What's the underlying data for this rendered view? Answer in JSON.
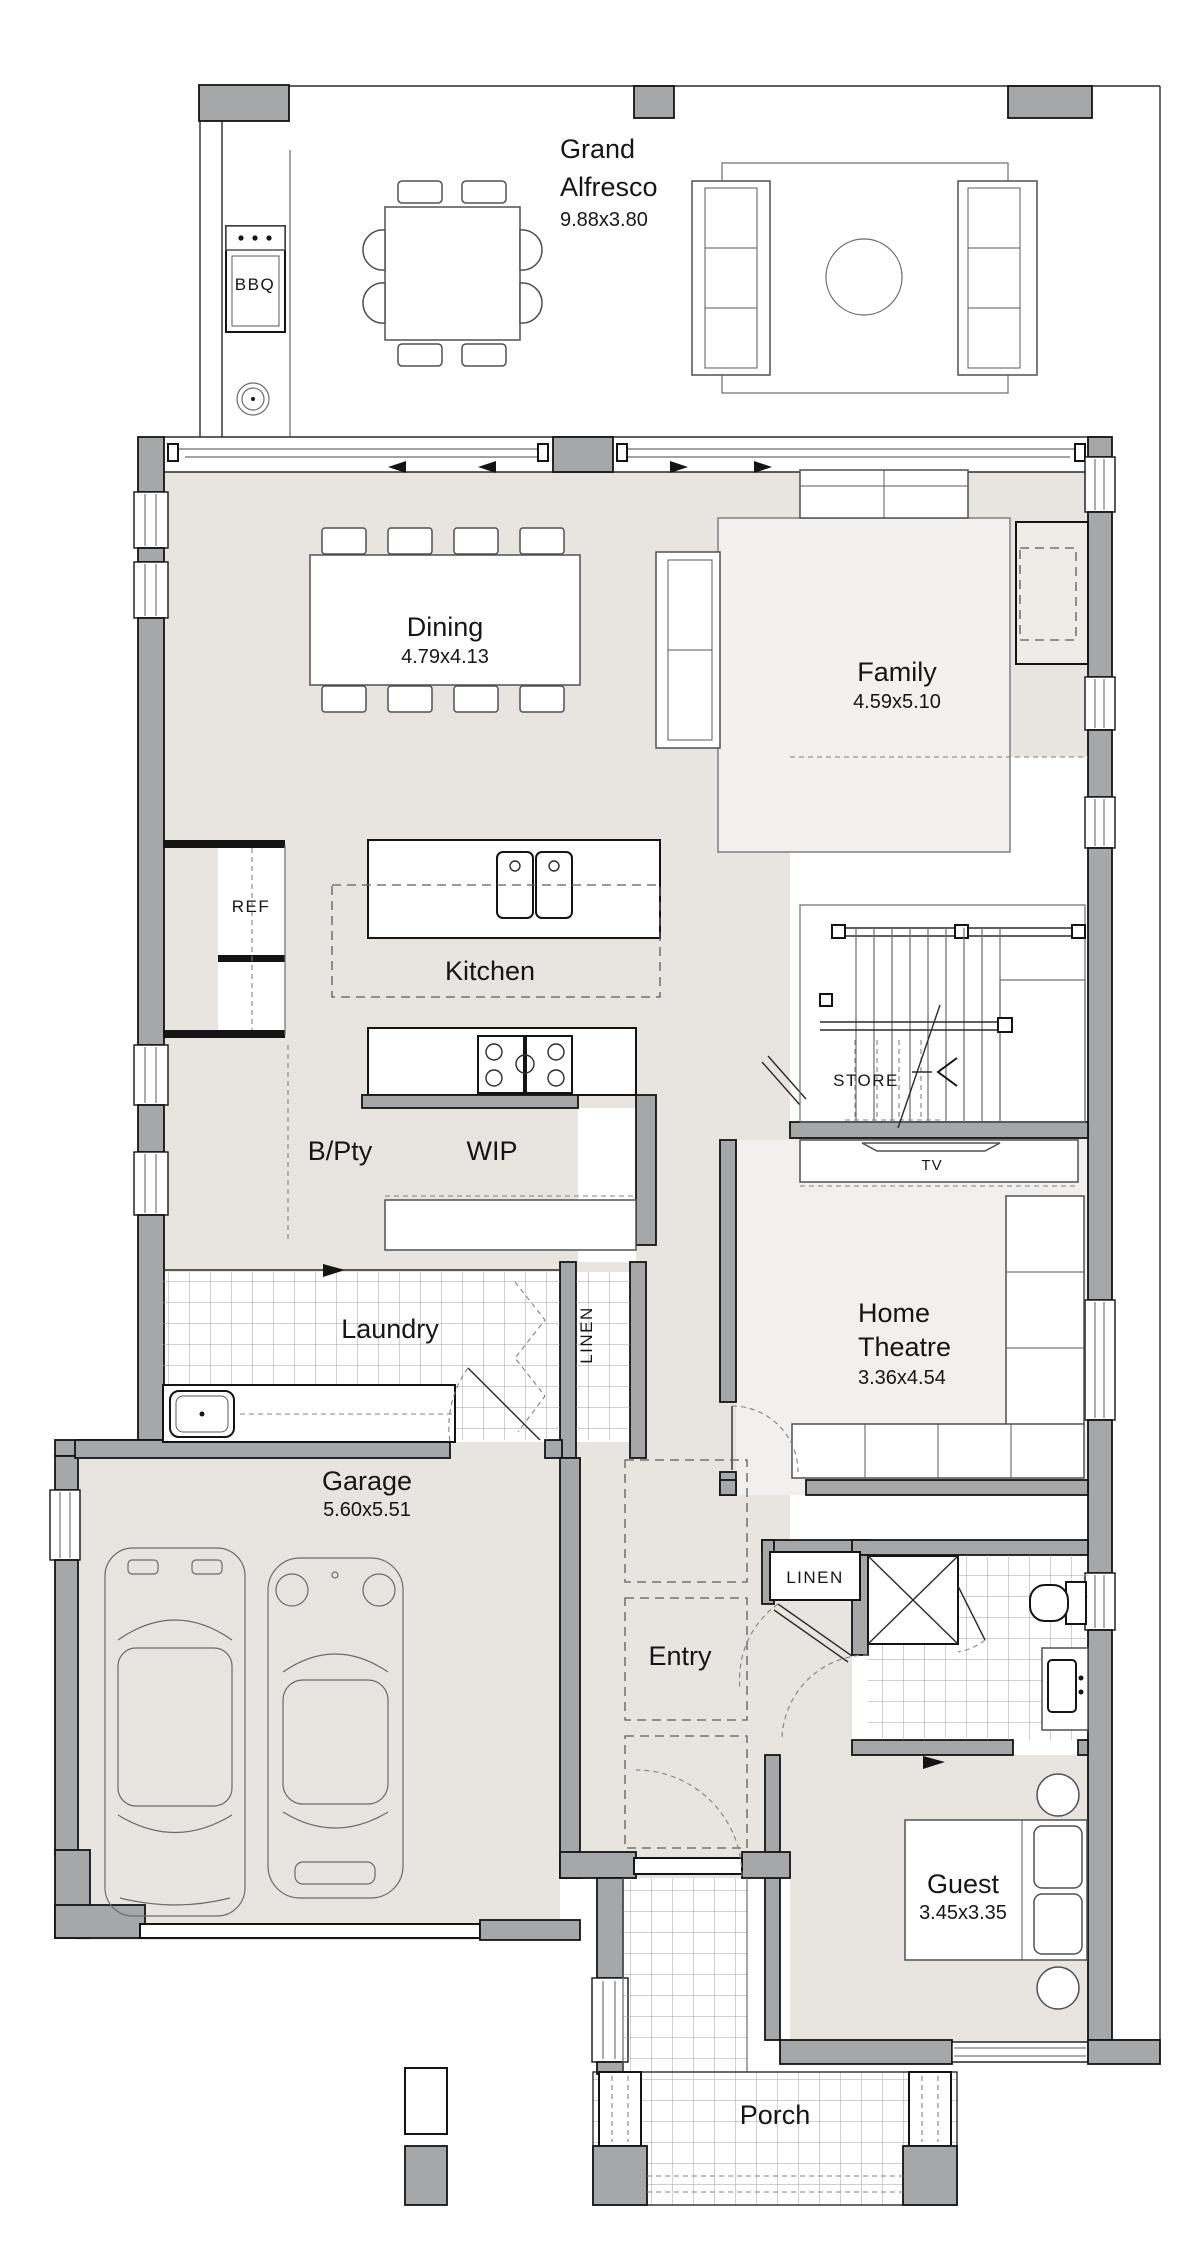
{
  "plan": {
    "type": "floor-plan",
    "colors": {
      "wall": "#a6a7a9",
      "floor": "#e8e4df",
      "rug": "#f2f1ef",
      "tile_line": "#9fa0a2",
      "outline": "#141414"
    },
    "labels": {
      "grand_alfresco": {
        "line1": "Grand",
        "line2": "Alfresco",
        "dims": "9.88x3.80"
      },
      "bbq": {
        "name": "BBQ"
      },
      "dining": {
        "name": "Dining",
        "dims": "4.79x4.13"
      },
      "family": {
        "name": "Family",
        "dims": "4.59x5.10"
      },
      "kitchen": {
        "name": "Kitchen"
      },
      "ref": {
        "name": "REF"
      },
      "bpty": {
        "name": "B/Pty"
      },
      "wip": {
        "name": "WIP"
      },
      "store": {
        "name": "STORE"
      },
      "tv": {
        "name": "TV"
      },
      "laundry": {
        "name": "Laundry"
      },
      "linen_laundry": {
        "name": "LINEN"
      },
      "home_theatre": {
        "line1": "Home",
        "line2": "Theatre",
        "dims": "3.36x4.54"
      },
      "garage": {
        "name": "Garage",
        "dims": "5.60x5.51"
      },
      "entry": {
        "name": "Entry"
      },
      "linen_entry": {
        "name": "LINEN"
      },
      "guest": {
        "name": "Guest",
        "dims": "3.45x3.35"
      },
      "porch": {
        "name": "Porch"
      }
    }
  }
}
